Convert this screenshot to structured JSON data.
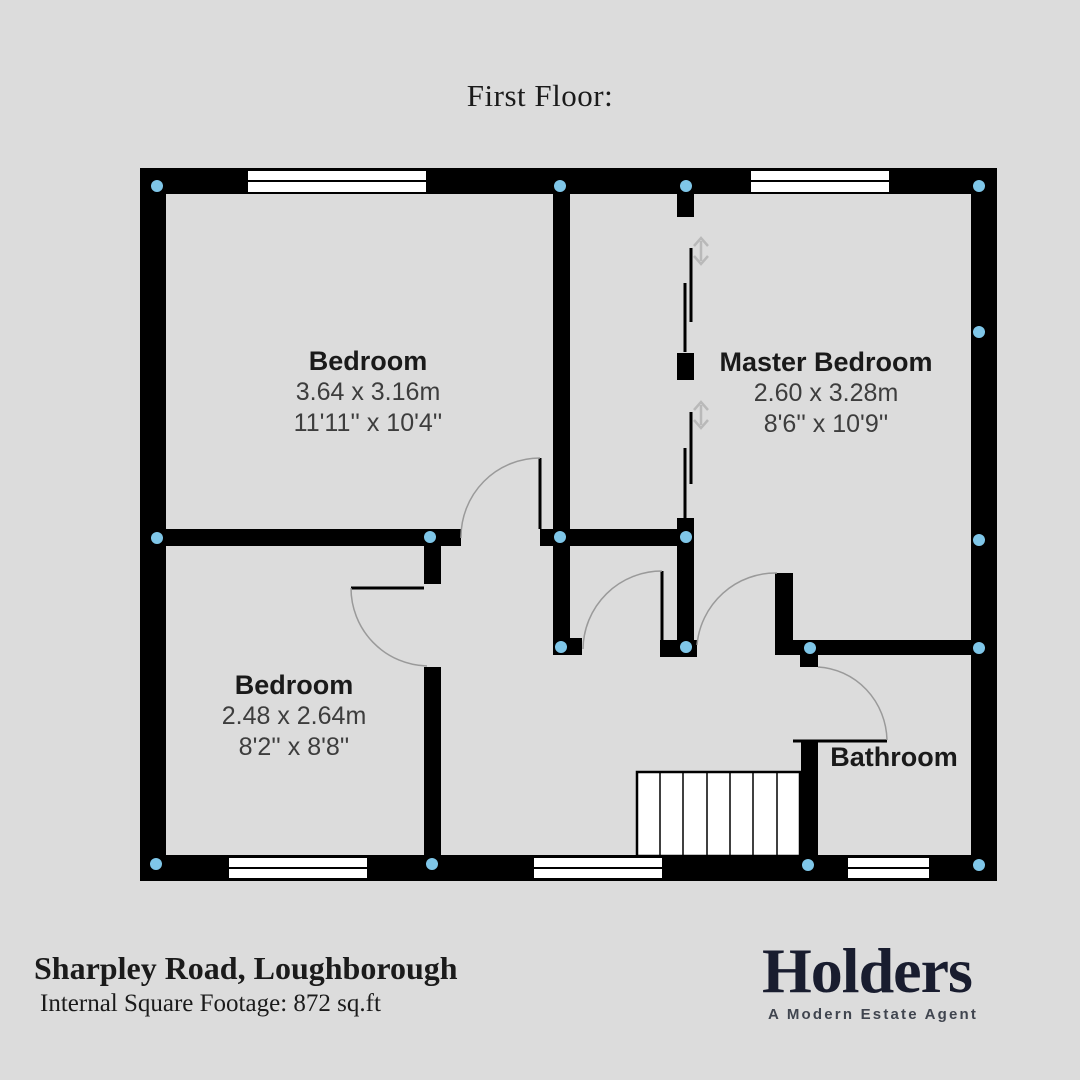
{
  "title": "First Floor:",
  "plan": {
    "rooms": [
      {
        "name": "Bedroom",
        "metric": "3.64 x 3.16m",
        "imperial": "11'11'' x 10'4''"
      },
      {
        "name": "Master Bedroom",
        "metric": "2.60 x 3.28m",
        "imperial": "8'6'' x 10'9''"
      },
      {
        "name": "Bedroom",
        "metric": "2.48 x 2.64m",
        "imperial": "8'2'' x 8'8''"
      },
      {
        "name": "Bathroom"
      }
    ]
  },
  "footer": {
    "address": "Sharpley Road, Loughborough",
    "footage": "Internal Square Footage: 872 sq.ft",
    "logo": "Holders",
    "tagline": "A Modern Estate Agent"
  },
  "colors": {
    "wall": "#000000",
    "marker_dot": "#7fc6e8",
    "door_arc": "#9a9a9a",
    "slide_arrow": "#b9b9b9",
    "background": "#dcdcdc",
    "logo": "#191d2f"
  }
}
